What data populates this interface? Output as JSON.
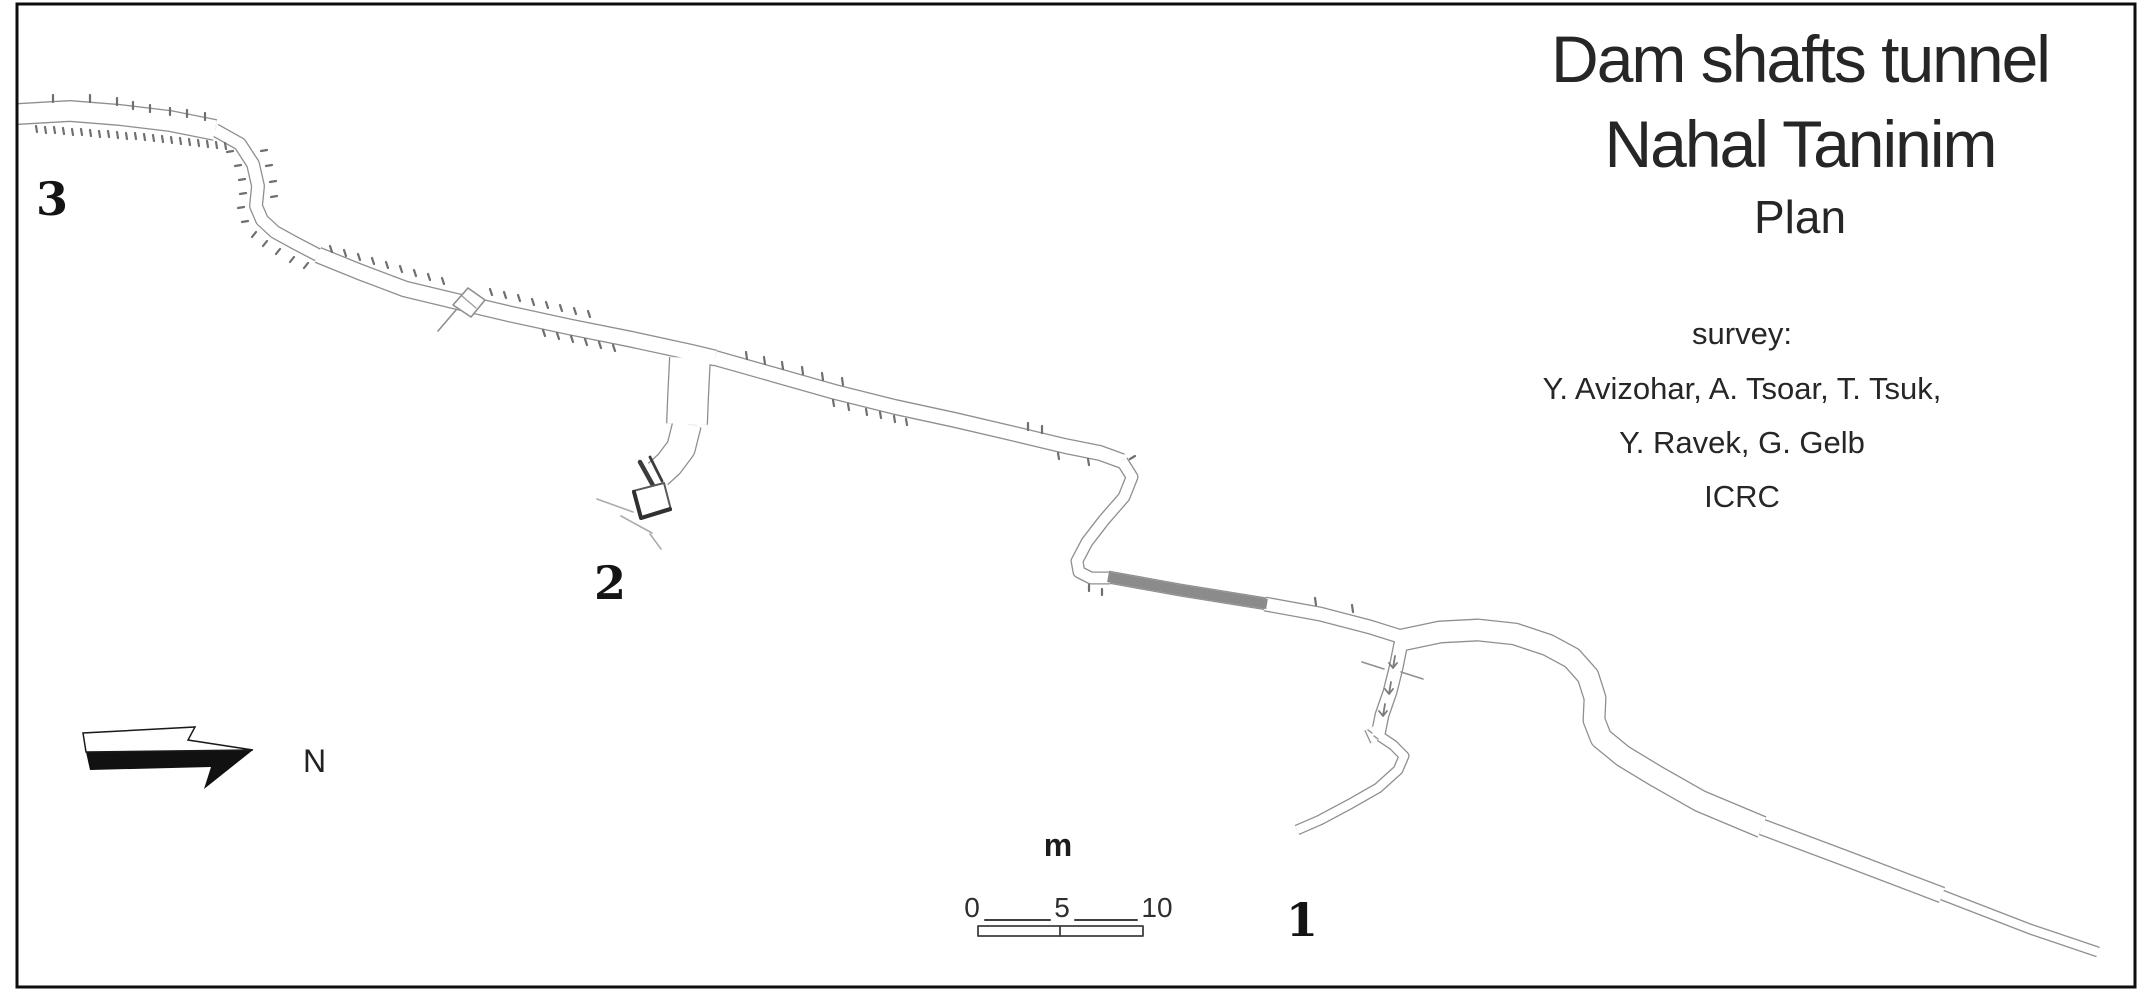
{
  "figure": {
    "title_line1": "Dam shafts tunnel",
    "title_line2": "Nahal Taninim",
    "subtitle": "Plan",
    "survey_heading": "survey:",
    "survey_line1": "Y. Avizohar, A. Tsoar, T. Tsuk,",
    "survey_line2": "Y. Ravek, G. Gelb",
    "survey_line3": "ICRC"
  },
  "labels": {
    "shaft1": "1",
    "shaft2": "2",
    "shaft3": "3"
  },
  "north": {
    "label": "N"
  },
  "scalebar": {
    "unit": "m",
    "tick0": "0",
    "tick5": "5",
    "tick10": "10"
  },
  "colors": {
    "wall": "#8f8f8f",
    "interior": "#ffffff",
    "flooded_gray": "#8b8b8b",
    "tick": "#6f6f6f",
    "ink": "#262626",
    "frame": "#0d0d0d"
  },
  "map": {
    "passages": [
      {
        "name": "nw-gallery-start",
        "d": "M18 114 L70 111 L120 115 L170 121 L215 130",
        "w": 22
      },
      {
        "name": "nw-bend",
        "d": "M215 130 L240 144 L253 164 L258 186 L256 206 L262 220 L275 232 L295 243 L318 255",
        "w": 14
      },
      {
        "name": "mid-gallery-west",
        "d": "M318 255 L360 272 L405 289 L455 301 L510 314 L570 327 L630 339 L690 352 L715 358",
        "w": 17
      },
      {
        "name": "mid-gallery-east",
        "d": "M715 358 L775 375 L835 392 L895 407 L955 420 L1015 434 L1065 446 L1100 453 L1122 461",
        "w": 16
      },
      {
        "name": "s-bend",
        "d": "M1122 461 L1132 477 L1124 497 L1104 520 L1087 542 L1077 561 L1079 572 L1091 578 L1110 578",
        "w": 13
      },
      {
        "name": "gray-segment-passage",
        "d": "M1108 577 L1180 590 L1267 604",
        "w": 13,
        "gray": true
      },
      {
        "name": "east-gallery",
        "d": "M1265 604 L1320 614 L1370 627 L1405 638",
        "w": 15
      },
      {
        "name": "shaft1-descent",
        "d": "M1402 638 L1396 668 L1390 692 L1382 715 L1378 735",
        "w": 15
      },
      {
        "name": "shaft1-chamber",
        "d": "M1372 727 L1378 740",
        "w": 17
      },
      {
        "name": "shaft1-hook",
        "d": "M1378 735 L1393 745 L1404 756 L1398 770 L1378 788 L1350 804 L1320 820 L1297 830",
        "w": 11
      },
      {
        "name": "se-loop",
        "d": "M1402 640 L1440 632 L1478 630 L1515 634 L1548 645 L1572 658 L1588 676 L1595 698 L1594 720 L1601 738 L1623 756 L1656 776 L1700 801 L1762 827",
        "w": 23
      },
      {
        "name": "se-tail-upper",
        "d": "M1762 827 L1850 860 L1942 895",
        "w": 17
      },
      {
        "name": "se-tail-lower",
        "d": "M1942 895 L2030 929 L2098 952",
        "w": 11
      },
      {
        "name": "shaft2-branch-upper",
        "d": "M690 358 L688 398 L687 424",
        "w": 42
      },
      {
        "name": "shaft2-branch-lower",
        "d": "M687 424 L681 448 L669 464 L658 474",
        "w": 30
      }
    ],
    "ticks": "M36 126l1 6M45 127l1 6M54 127l1 6M63 128l1 6M72 129l1 6M81 129l1 6M90 130l1 6M99 131l1 6M108 131l1 6M117 132l1 6M126 133l1 6M135 133l1 6M144 134l1 6M153 135l1 6M162 136l1 6M171 137l1 6M180 138l1 6M189 139l1 6M198 140l1 6M207 141l1 6M216 142l1 6M225 143l1 6M53 102l0 -7M90 102l0 -7M117 105l0 -7M133 109l0 -7M150 112l0 -7M170 115l0 -7M187 117l0 -7M205 120l0 -7M233 151l-6 1M241 165l-6 1M245 179l-6 1M246 193l-6 1M244 207l-6 1M248 221l-6 1M256 232l-4 5M267 241l-4 5M280 249l-4 5M294 257l-4 5M308 263l-4 5M261 151l6 -1M266 166l6 -1M270 182l6 -1M271 197l6 -1M332 252l-2 -6M346 256l-2 -6M360 260l-2 -6M374 264l-2 -6M388 268l-2 -6M402 272l-2 -6M416 276l-2 -6M430 280l-2 -6M444 284l-2 -6M492 295l-2 -6M506 298l-2 -6M520 301l-2 -6M534 305l-2 -6M548 308l-2 -6M562 311l-2 -6M576 314l-2 -6M590 317l-2 -6M543 330l2 6M557 333l2 6M571 336l2 6M585 339l2 6M599 342l2 6M613 345l2 6M747 359l-1 -7M765 364l-1 -7M783 369l-1 -7M803 374l-1 -7M823 380l-1 -7M843 385l-1 -7M833 400l1 6M848 404l1 6M866 409l1 6M880 412l1 6M894 416l1 6M906 419l1 6M1028 430l0 -7M1042 433l0 -7M1058 453l1 6M1088 459l1 6M1130 459l5 -3M1089 585l0 6M1102 589l0 6M1316 605l-1 -7M1353 612l-1 -7",
    "details": [
      {
        "name": "mid-structure-diamond",
        "d": "M468 288 L485 300 L471 317 L453 305 Z",
        "stroke": "#8f8f8f",
        "w": 1.6,
        "fill": "#ffffff"
      },
      {
        "name": "mid-structure-tail",
        "d": "M456 310 L438 331",
        "stroke": "#8f8f8f",
        "w": 1.6
      },
      {
        "name": "mid-structure-cross",
        "d": "M462 296 L476 308",
        "stroke": "#9a9a9a",
        "w": 1.2
      },
      {
        "name": "shaft2-dark-bar-1",
        "d": "M640 462 L655 489",
        "stroke": "#3c3c3c",
        "w": 4.5
      },
      {
        "name": "shaft2-dark-bar-2",
        "d": "M650 457 L662 481",
        "stroke": "#3c3c3c",
        "w": 2.8
      },
      {
        "name": "shaft2-mouth-rect",
        "d": "M633 491 L664 483 L671 510 L641 519 Z",
        "stroke": "#5a5a5a",
        "w": 2,
        "fill": "#ffffff"
      },
      {
        "name": "shaft2-mouth-edge",
        "d": "M634 492 L641 518 L670 509",
        "stroke": "#303030",
        "w": 4
      },
      {
        "name": "shaft2-ground-line-1",
        "d": "M597 499 L633 512",
        "stroke": "#ababab",
        "w": 1.6
      },
      {
        "name": "shaft2-ground-line-2",
        "d": "M621 516 L652 533",
        "stroke": "#ababab",
        "w": 1.6
      },
      {
        "name": "shaft2-ground-line-3",
        "d": "M650 534 L661 549",
        "stroke": "#ababab",
        "w": 1.6
      },
      {
        "name": "shaft1-step-line-left",
        "d": "M1362 662 L1384 669",
        "stroke": "#8f8f8f",
        "w": 1.6
      },
      {
        "name": "shaft1-step-line-right",
        "d": "M1401 672 L1423 679",
        "stroke": "#8f8f8f",
        "w": 1.6
      },
      {
        "name": "slope-arrow-1",
        "d": "M1395 656 L1393 668 M1389 663 L1393 668 L1397 663",
        "stroke": "#7a7a7a",
        "w": 1.8
      },
      {
        "name": "slope-arrow-2",
        "d": "M1391 682 L1389 694 M1385 689 L1389 694 L1393 689",
        "stroke": "#7a7a7a",
        "w": 1.8
      },
      {
        "name": "slope-arrow-3",
        "d": "M1385 704 L1383 716 M1379 711 L1383 716 L1387 711",
        "stroke": "#7a7a7a",
        "w": 1.8
      },
      {
        "name": "chamber-marks",
        "d": "M1368 730 l4 3 M1374 736 l4 3",
        "stroke": "#9a9a9a",
        "w": 1.5
      },
      {
        "name": "scalebar-line-left",
        "d": "M985 920 L1050 920",
        "stroke": "#3f3f3f",
        "w": 2
      },
      {
        "name": "scalebar-line-right",
        "d": "M1075 920 L1137 920",
        "stroke": "#3f3f3f",
        "w": 2
      },
      {
        "name": "scalebar-box",
        "d": "M978 926 L1143 926 L1143 936 L978 936 Z",
        "stroke": "#3f3f3f",
        "w": 1.8,
        "fill": "#ffffff"
      },
      {
        "name": "scalebar-divider",
        "d": "M1060 926 L1060 936",
        "stroke": "#3f3f3f",
        "w": 1.8
      }
    ],
    "north_arrow": {
      "white_half": "86,752 83,733 195,727 188,740 253,750",
      "black_half": "86,752 253,750 204,789 211,767 90,770"
    }
  }
}
